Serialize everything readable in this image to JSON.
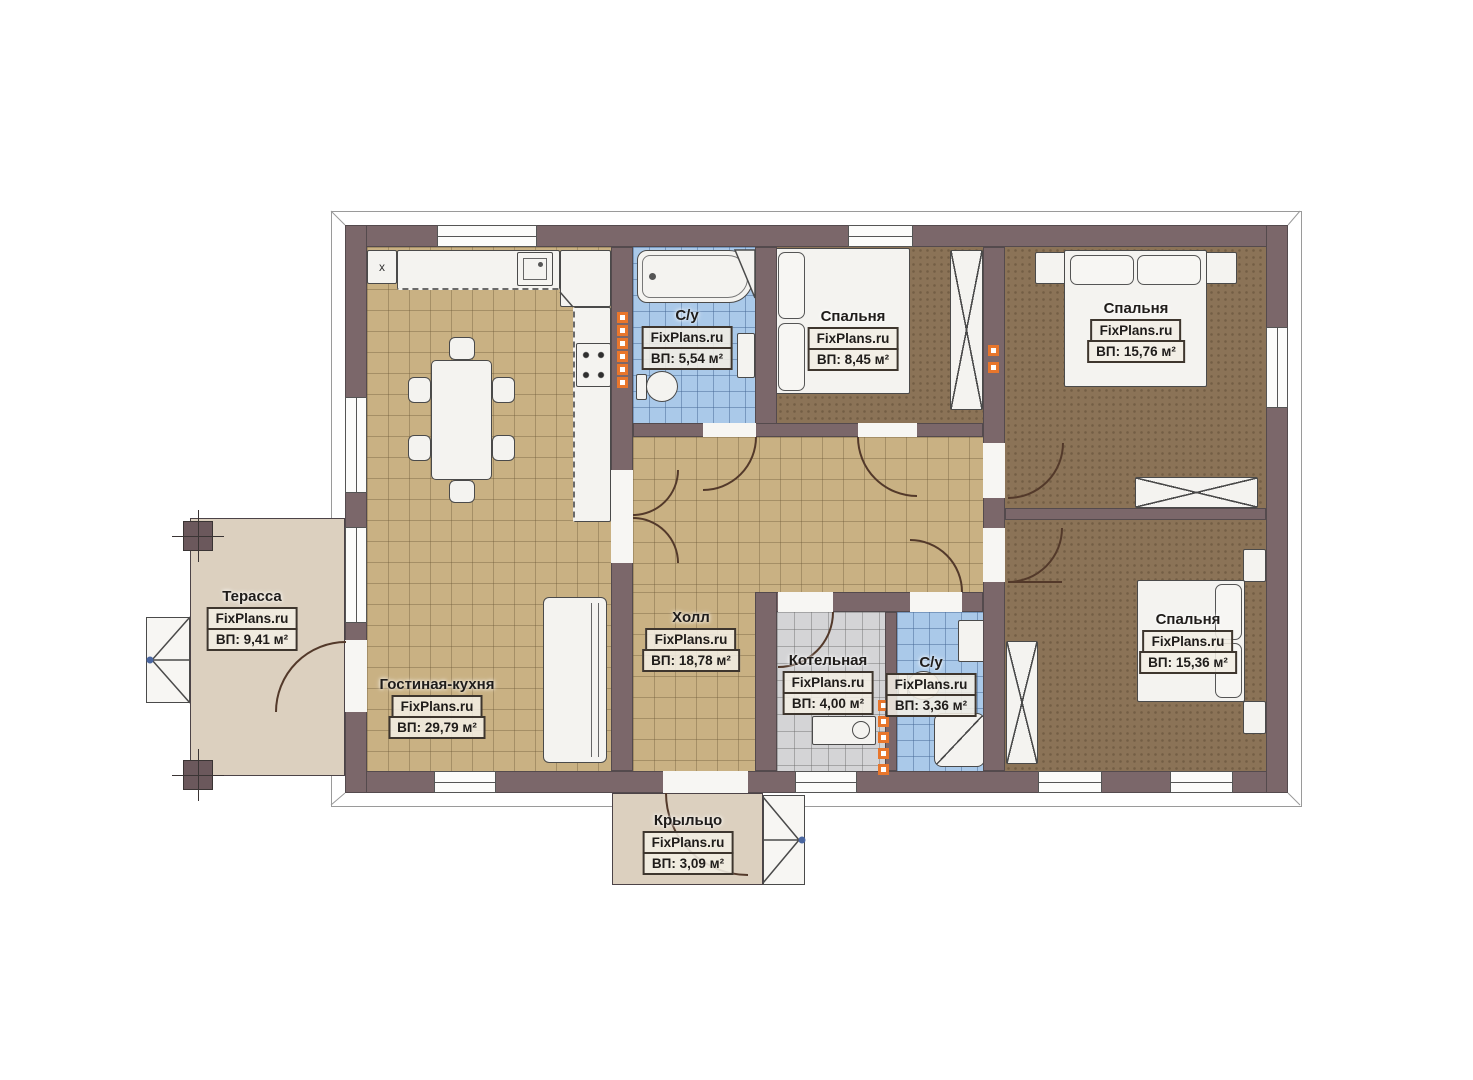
{
  "plan_title": "Floor plan",
  "brand": "FixPlans.ru",
  "fixtures": {
    "fridge_label": "x"
  },
  "rooms": {
    "terrace": {
      "name": "Терасса",
      "brand": "FixPlans.ru",
      "area": "ВП: 9,41 м²"
    },
    "living": {
      "name": "Гостиная-кухня",
      "brand": "FixPlans.ru",
      "area": "ВП: 29,79 м²"
    },
    "bath1": {
      "name": "С/у",
      "brand": "FixPlans.ru",
      "area": "ВП: 5,54 м²"
    },
    "bedroom1": {
      "name": "Спальня",
      "brand": "FixPlans.ru",
      "area": "ВП: 8,45 м²"
    },
    "bedroom2": {
      "name": "Спальня",
      "brand": "FixPlans.ru",
      "area": "ВП: 15,76 м²"
    },
    "hall": {
      "name": "Холл",
      "brand": "FixPlans.ru",
      "area": "ВП: 18,78 м²"
    },
    "boiler": {
      "name": "Котельная",
      "brand": "FixPlans.ru",
      "area": "ВП: 4,00 м²"
    },
    "bath2": {
      "name": "С/у",
      "brand": "FixPlans.ru",
      "area": "ВП: 3,36 м²"
    },
    "bedroom3": {
      "name": "Спальня",
      "brand": "FixPlans.ru",
      "area": "ВП: 15,36 м²"
    },
    "porch": {
      "name": "Крыльцо",
      "brand": "FixPlans.ru",
      "area": "ВП: 3,09 м²"
    }
  },
  "colors": {
    "wall": "#7b676a",
    "tile_tan": "#c9b183",
    "tile_blue": "#aac9e9",
    "tile_gray": "#d4d4d6",
    "carpet_brown": "#8b7357",
    "deck_beige": "#dcd0bf",
    "marker_orange": "#e8762c"
  }
}
